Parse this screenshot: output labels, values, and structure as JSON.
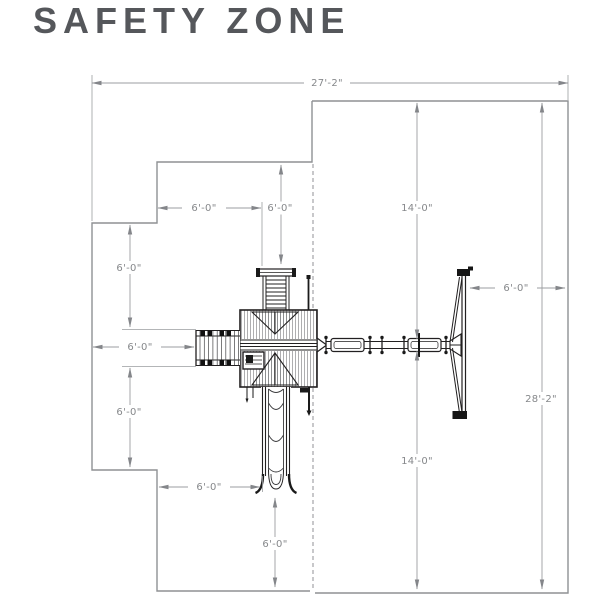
{
  "title": "SAFETY ZONE",
  "drawing": {
    "dimensions": [
      {
        "id": "total-width",
        "label": "27'-2\""
      },
      {
        "id": "upper-step-width",
        "label": "6'-0\""
      },
      {
        "id": "climber-clearance",
        "label": "6'-0\""
      },
      {
        "id": "swing-zone-upper",
        "label": "14'-0\""
      },
      {
        "id": "left-upper-clearance",
        "label": "6'-0\""
      },
      {
        "id": "monkeybar-clearance",
        "label": "6'-0\""
      },
      {
        "id": "swing-end-clearance",
        "label": "6'-0\""
      },
      {
        "id": "total-height",
        "label": "28'-2\""
      },
      {
        "id": "left-lower-clearance",
        "label": "6'-0\""
      },
      {
        "id": "swing-zone-lower",
        "label": "14'-0\""
      },
      {
        "id": "slide-side-clearance",
        "label": "6'-0\""
      },
      {
        "id": "slide-end-clearance",
        "label": "6'-0\""
      }
    ],
    "colors": {
      "outline": "#8f9194",
      "dimension": "#9b9da0",
      "structure": "#222021",
      "title_text": "#55575b"
    }
  }
}
